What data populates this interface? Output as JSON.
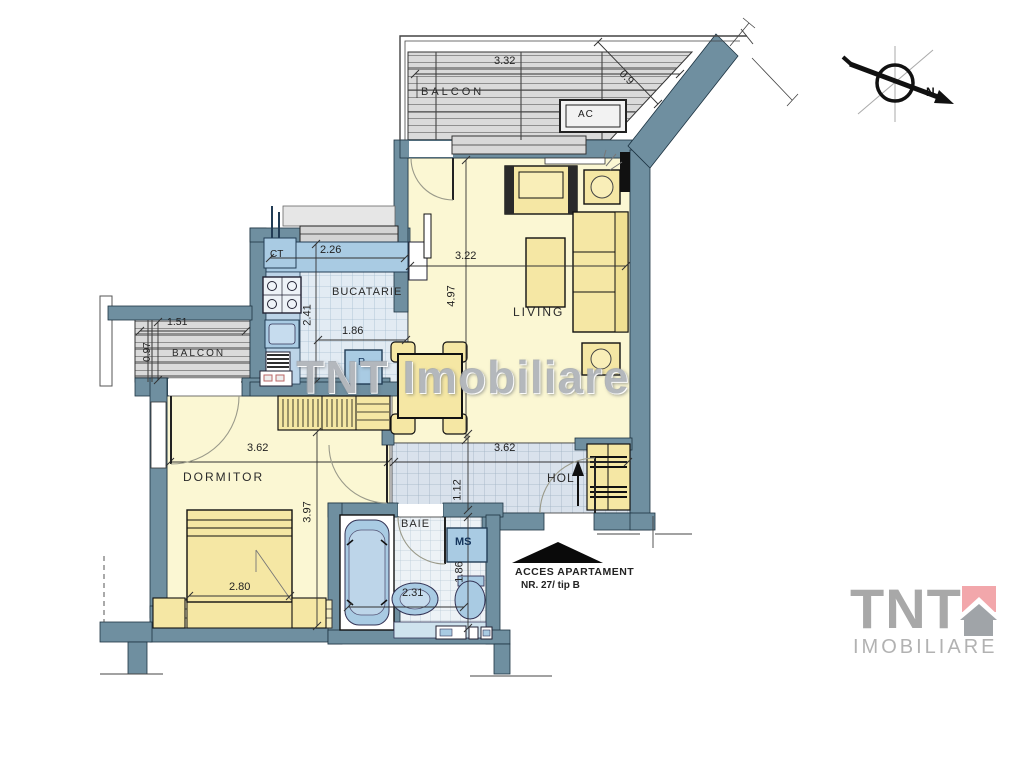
{
  "watermark": "TNT Imobiliare",
  "compass_label": "N",
  "rooms": {
    "balcony_top": {
      "label": "BALCON",
      "width": "3.32",
      "diagonal": "0.9",
      "ac": "AC"
    },
    "kitchen": {
      "label": "BUCATARIE",
      "width": "2.26",
      "depth": "2.41",
      "opening": "1.86",
      "boiler": "CT",
      "fridge": "R"
    },
    "living": {
      "label": "LIVING",
      "width": "3.22",
      "depth": "4.97"
    },
    "balcony_left": {
      "label": "BALCON",
      "width": "1.51",
      "depth": "0.97"
    },
    "bedroom": {
      "label": "DORMITOR",
      "width": "3.62",
      "depth": "3.97",
      "bed_width": "2.80"
    },
    "hall": {
      "label": "HOL",
      "width": "3.62",
      "depth": "1.12"
    },
    "bathroom": {
      "label": "BAIE",
      "width": "2.31",
      "depth": "1.86",
      "washer": "MS"
    }
  },
  "access": {
    "line1": "ACCES APARTAMENT",
    "line2": "NR. 27/ tip B"
  },
  "logo": {
    "name": "TNT",
    "subtitle": "IMOBILIARE"
  },
  "colors": {
    "wall": "#6f8fa0",
    "floor": "#fbf7d3",
    "fixture_blue": "#a9cbe3",
    "logo_pink": "#f2a7ab"
  }
}
